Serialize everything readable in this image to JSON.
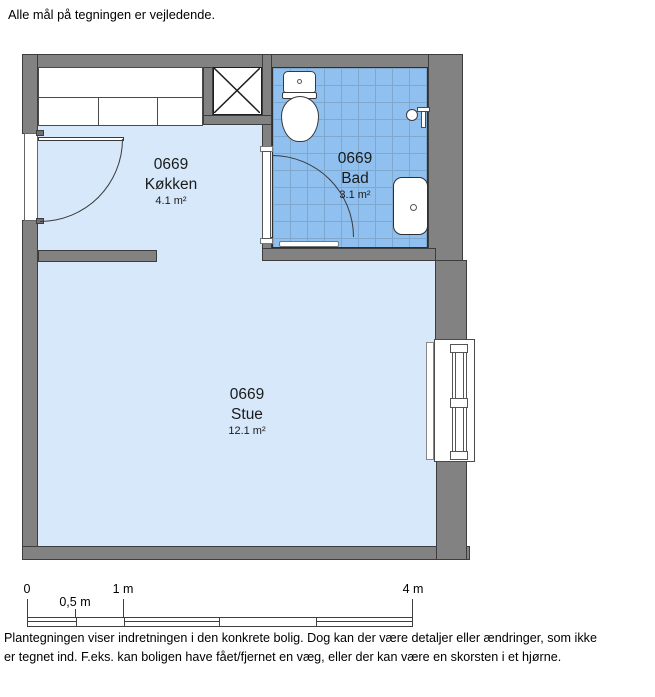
{
  "page": {
    "top_note": "Alle mål på tegningen er vejledende.",
    "footer": {
      "line1": "Plantegningen viser indretningen i den konkrete bolig. Dog kan der være detaljer eller ændringer, som ikke",
      "line2": "er tegnet ind. F.eks. kan boligen have fået/fjernet en væg, eller der kan være en skorsten i et hjørne."
    }
  },
  "floorplan": {
    "rooms": [
      {
        "number": "0669",
        "name": "Køkken",
        "area": "4.1 m²"
      },
      {
        "number": "0669",
        "name": "Bad",
        "area": "3.1 m²"
      },
      {
        "number": "0669",
        "name": "Stue",
        "area": "12.1 m²"
      }
    ],
    "fixtures": [
      "kitchen-counter",
      "shaft",
      "toilet",
      "shower-mixer",
      "sink",
      "bath-door",
      "entrance-door",
      "radiator",
      "window"
    ],
    "colors": {
      "wall": "#828282",
      "wall_outline": "#3d3d3d",
      "floor": "#D7E8FB",
      "bath_tile": "#8FC0F0",
      "bath_tile_grid": "#7FA8CE"
    }
  },
  "scalebar": {
    "tick_labels": [
      "0",
      "0,5 m",
      "1 m",
      "4 m"
    ]
  }
}
